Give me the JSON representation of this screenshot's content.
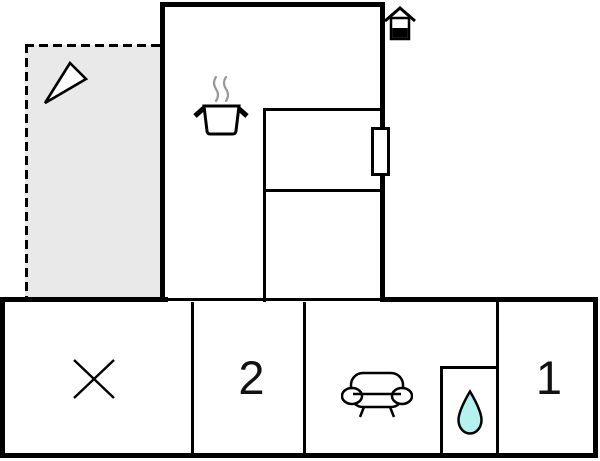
{
  "colors": {
    "background": "#ffffff",
    "wall": "#000000",
    "terrace_fill": "#e9e9e9",
    "window_fill": "#ffffff",
    "drop_fill": "#b5f1ee",
    "steam": "#999999",
    "label": "#111111"
  },
  "labels": {
    "bedroom_left": "2",
    "bedroom_right": "1"
  },
  "icons": {
    "terrace": "compass-triangle-icon",
    "kitchen": "cooking-pot-icon",
    "entrance": "house-icon",
    "crossed_room": "x-mark-icon",
    "living_room": "sofa-icon",
    "bathroom": "water-drop-icon"
  }
}
